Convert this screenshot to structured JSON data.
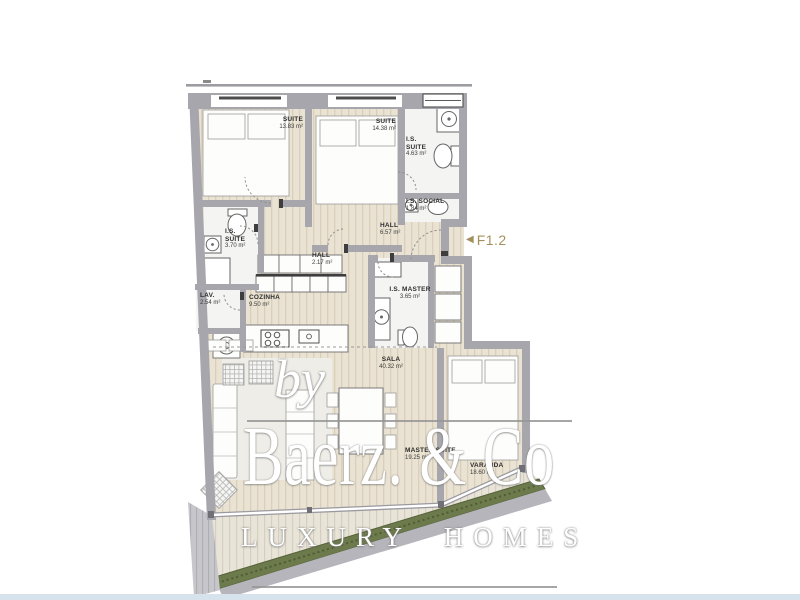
{
  "plan": {
    "unit": {
      "arrow": "◀",
      "label": "F1.2",
      "color": "#a3905c"
    },
    "rooms": {
      "suite1": {
        "name": "SUITE",
        "area": "13.83 m²"
      },
      "suite2": {
        "name": "SUITE",
        "area": "14.38 m²"
      },
      "is_suite_top": {
        "name": "I.S. SUITE",
        "area": "4.63 m²"
      },
      "is_social": {
        "name": "I.S. SOCIAL",
        "area": "1.84 m²"
      },
      "is_suite_left": {
        "name": "I.S. SUITE",
        "area": "3.70 m²"
      },
      "hall_small": {
        "name": "HALL",
        "area": "2.17 m²"
      },
      "hall_main": {
        "name": "HALL",
        "area": "6.57 m²"
      },
      "lav": {
        "name": "LAV.",
        "area": "2.54 m²"
      },
      "cozinha": {
        "name": "COZINHA",
        "area": "9.50 m²"
      },
      "is_master": {
        "name": "I.S. MASTER",
        "area": "3.65 m²"
      },
      "sala": {
        "name": "SALA",
        "area": "40.32 m²"
      },
      "master_suite": {
        "name": "MASTER SUITE",
        "area": "19.25 m²"
      },
      "varanda": {
        "name": "VARANDA",
        "area": "18.60 m²"
      }
    }
  },
  "watermark": {
    "prefix": "by",
    "brand": "Baerz. & Co",
    "tagline": "LUXURY HOMES"
  },
  "colors": {
    "wall": "#a6a6ac",
    "floor_wood": "#eae3d3",
    "floor_stripe": "#d9cfba",
    "bath_floor": "#f4f4f2",
    "hedge_green": "#6d7a4c",
    "deck_gray": "#c6c6cb",
    "accent_tan": "#a3905c",
    "bottom_bar_blue": "#d7e3ec"
  }
}
